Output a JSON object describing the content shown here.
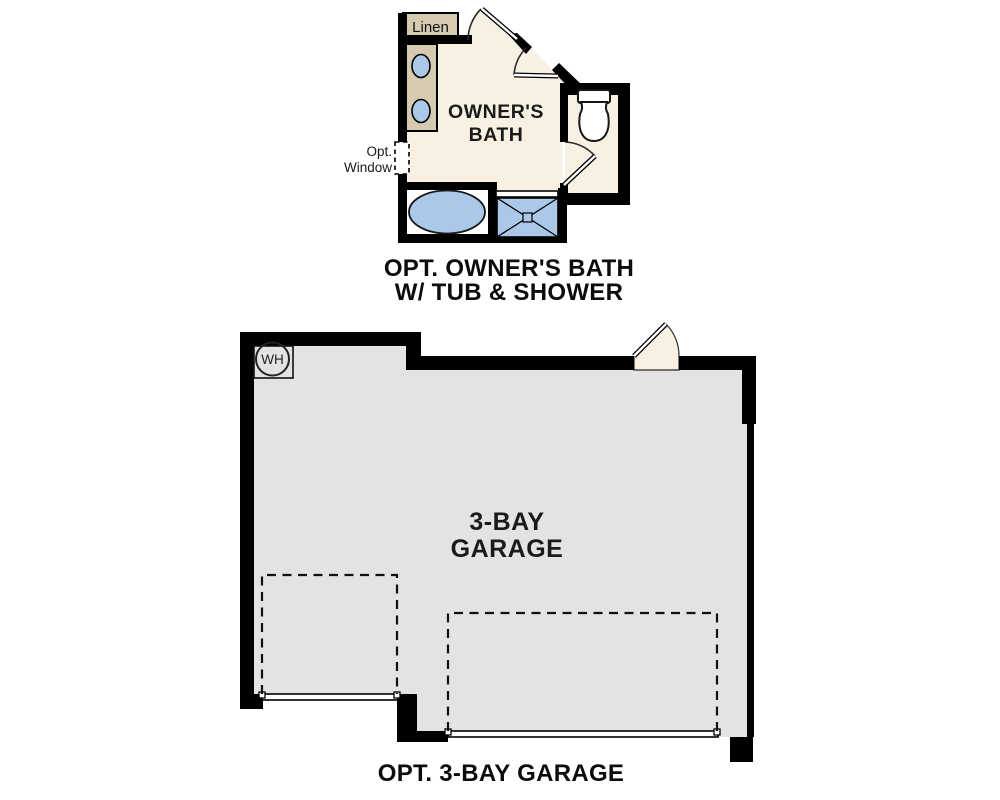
{
  "bath_plan": {
    "room_label_line1": "OWNER'S",
    "room_label_line2": "BATH",
    "linen_label": "Linen",
    "window_label_line1": "Opt.",
    "window_label_line2": "Window",
    "caption_line1": "OPT. OWNER'S BATH",
    "caption_line2": "W/ TUB & SHOWER"
  },
  "garage_plan": {
    "room_label_line1": "3-BAY",
    "room_label_line2": "GARAGE",
    "water_heater_label": "WH",
    "caption": "OPT. 3-BAY GARAGE"
  },
  "colors": {
    "floor_cream": "#f7f0e3",
    "cabinet_tan": "#d6cbb1",
    "fixture_blue": "#abc8e9",
    "garage_gray": "#e4e3e1",
    "wall_black": "#000000"
  }
}
